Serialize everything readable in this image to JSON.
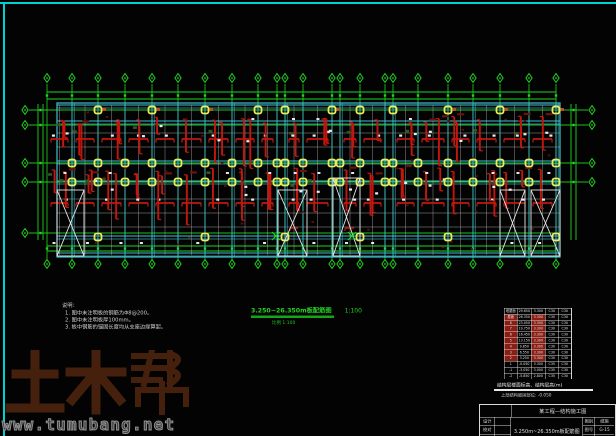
{
  "app": {
    "background": "#030303",
    "frame_color": "#00d2d2"
  },
  "watermark": {
    "brand": "土木帮",
    "url": "www.tumubang.net",
    "brand_color": "#45210d",
    "url_color": "#969696"
  },
  "notes": {
    "heading": "说明：",
    "items": [
      "1. 图中未注明板的钢筋为Φ8@200。",
      "2. 图中未注明板厚100mm。",
      "3. 板中钢筋的锚固长度均从支座边缘算起。"
    ]
  },
  "drawing_title": {
    "text": "3.250~26.350m板配筋图",
    "scale": "1:100",
    "subtitle": "比例 1:100",
    "color": "#23d523"
  },
  "floor_table": {
    "caption": "结构层楼面标高、结构层高(m)",
    "footnote": "上部结构嵌固部位: -0.050",
    "headers": [
      "层号",
      "标高(m)",
      "层高(m)",
      "墙柱",
      "梁板"
    ],
    "rows": [
      [
        "塔屋面",
        "29.650",
        "3.300",
        "C30",
        "C30"
      ],
      [
        "屋面",
        "26.350",
        "3.300",
        "C30",
        "C30"
      ],
      [
        "8",
        "23.050",
        "3.300",
        "C30",
        "C30"
      ],
      [
        "7",
        "19.750",
        "3.300",
        "C30",
        "C30"
      ],
      [
        "6",
        "16.450",
        "3.300",
        "C30",
        "C30"
      ],
      [
        "5",
        "13.150",
        "3.300",
        "C30",
        "C30"
      ],
      [
        "4",
        "9.850",
        "3.300",
        "C30",
        "C30"
      ],
      [
        "3",
        "6.550",
        "3.300",
        "C30",
        "C30"
      ],
      [
        "2",
        "3.250",
        "3.300",
        "C30",
        "C30"
      ],
      [
        "1",
        "-0.050",
        "3.300",
        "C35",
        "C30"
      ],
      [
        "-1",
        "-3.050",
        "3.000",
        "C35",
        "C30"
      ],
      [
        "-2",
        "-5.850",
        "2.800",
        "C35",
        "C30"
      ]
    ],
    "highlight_rows": [
      1,
      2,
      3,
      4,
      5,
      6,
      7,
      8
    ],
    "highlight_color": "#8c1d12"
  },
  "title_block": {
    "project": "某工程—结构施工图",
    "drawing_name": "3.250m~26.350m板配筋图",
    "left_labels": [
      "设计",
      "校对",
      "审核"
    ],
    "right_rows": [
      [
        "图别",
        "结施"
      ],
      [
        "图号",
        "G-15"
      ],
      [
        "日期",
        "2013"
      ]
    ]
  },
  "plan": {
    "axes_x": [
      47,
      72,
      98,
      125,
      152,
      178,
      205,
      232,
      258,
      277,
      285,
      303,
      332,
      340,
      360,
      385,
      393,
      418,
      448,
      473,
      500,
      529,
      556
    ],
    "axes_y": [
      110,
      125,
      163,
      182,
      233
    ],
    "slab": {
      "x1": 57,
      "y1": 103,
      "x2": 560,
      "y2": 257
    },
    "cyan_rows": [
      105,
      121,
      161,
      181,
      236,
      253
    ],
    "white_rows": [
      133,
      147,
      199,
      213,
      227
    ],
    "bands": [
      [
        114,
        158
      ],
      [
        166,
        231
      ]
    ],
    "red_rows": [
      139,
      203
    ],
    "column_rows": [
      {
        "y": 110,
        "step": 2,
        "start": 0,
        "accent": true
      },
      {
        "y": 163,
        "step": 1,
        "start": 0
      },
      {
        "y": 182,
        "step": 1,
        "start": 0
      },
      {
        "y": 237,
        "step": 4,
        "start": 2
      }
    ],
    "openings": [
      [
        57,
        190,
        27,
        66
      ],
      [
        278,
        190,
        29,
        66
      ],
      [
        333,
        178,
        27,
        78
      ],
      [
        500,
        190,
        25,
        66
      ],
      [
        531,
        190,
        29,
        66
      ]
    ],
    "green_x": [
      [
        276,
        236
      ],
      [
        352,
        236
      ]
    ],
    "colors": {
      "axis": "#1fd41f",
      "grid": "#3fbfcf",
      "white": "#d8d8d8",
      "rebar": "#c2170e",
      "rebar_dark": "#6e130b",
      "column": "#ecec5a",
      "col_accent": "#b5541a",
      "olive": "#37551c"
    },
    "seed": 7
  }
}
